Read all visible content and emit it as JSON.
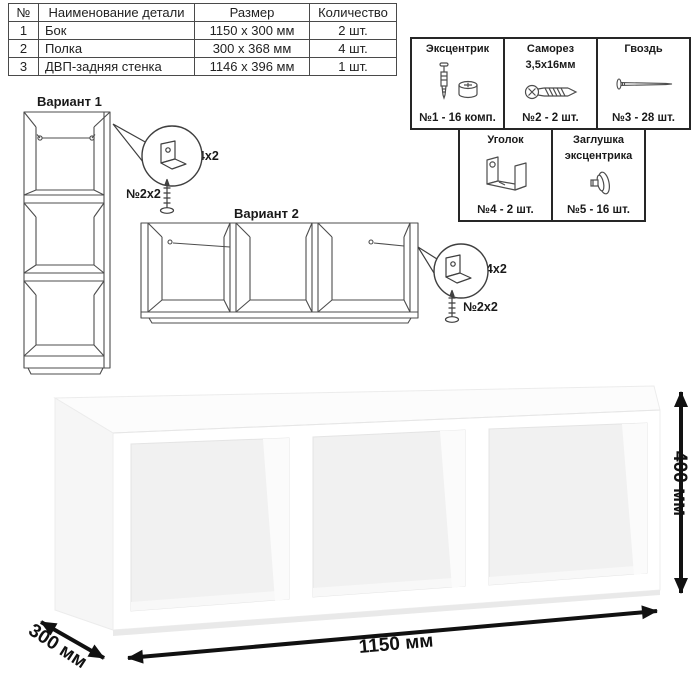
{
  "parts_table": {
    "headers": {
      "num": "№",
      "name": "Наименование детали",
      "size": "Размер",
      "qty": "Количество"
    },
    "rows": [
      {
        "num": "1",
        "name": "Бок",
        "size": "1150 x 300 мм",
        "qty": "2 шт."
      },
      {
        "num": "2",
        "name": "Полка",
        "size": "300 x 368 мм",
        "qty": "4 шт."
      },
      {
        "num": "3",
        "name": "ДВП-задняя стенка",
        "size": "1146 x 396 мм",
        "qty": "1 шт."
      }
    ]
  },
  "hardware": {
    "items": [
      {
        "title": "Эксцентрик",
        "subtitle": "",
        "icon": "cam-bolt-and-lock-icon",
        "count": "№1 - 16 комп."
      },
      {
        "title": "Саморез",
        "subtitle": "3,5х16мм",
        "icon": "screw-icon",
        "count": "№2 - 2 шт."
      },
      {
        "title": "Гвоздь",
        "subtitle": "",
        "icon": "nail-icon",
        "count": "№3 - 28 шт."
      },
      {
        "title": "Уголок",
        "subtitle": "",
        "icon": "corner-bracket-icon",
        "count": "№4 - 2 шт."
      },
      {
        "title": "Заглушка",
        "subtitle": "эксцентрика",
        "icon": "cam-cap-icon",
        "count": "№5 - 16 шт."
      }
    ]
  },
  "variants": {
    "v1": {
      "title": "Вариант 1",
      "bracket_label": "№4х2",
      "screw_label": "№2х2"
    },
    "v2": {
      "title": "Вариант 2",
      "bracket_label": "№4х2",
      "screw_label": "№2х2"
    }
  },
  "dimensions": {
    "width": "1150 мм",
    "height": "400 мм",
    "depth": "300 мм"
  },
  "colors": {
    "line": "#4d4d4d",
    "arrow": "#111111",
    "shelf_shadow": "#e9e9e9"
  }
}
